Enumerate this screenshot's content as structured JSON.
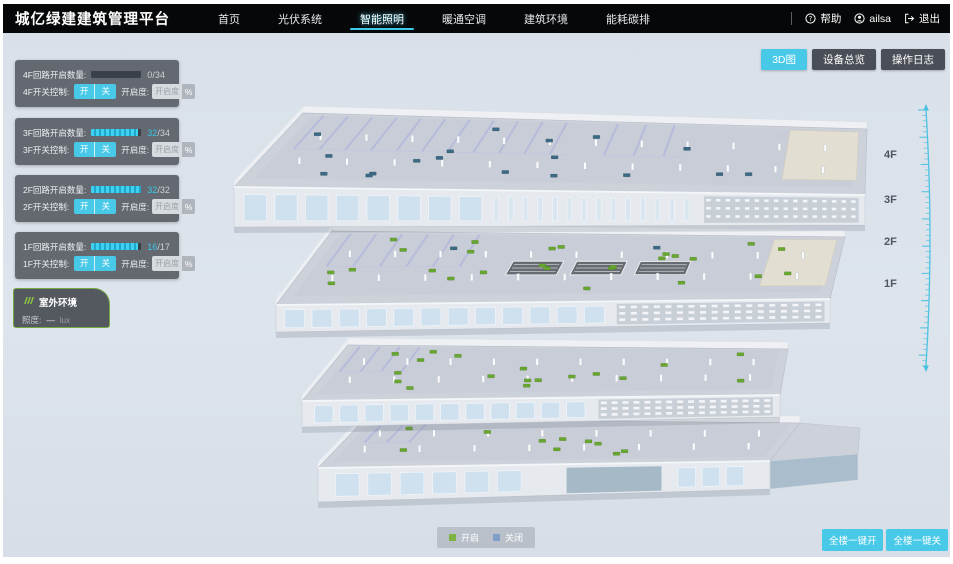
{
  "header": {
    "title": "城亿绿建建筑管理平台",
    "nav": [
      {
        "label": "首页"
      },
      {
        "label": "光伏系统"
      },
      {
        "label": "智能照明"
      },
      {
        "label": "暖通空调"
      },
      {
        "label": "建筑环境"
      },
      {
        "label": "能耗碳排"
      }
    ],
    "active_nav": "智能照明",
    "help": "帮助",
    "user": "ailsa",
    "logout": "退出"
  },
  "toolbar": {
    "buttons": [
      {
        "label": "3D图",
        "active": true
      },
      {
        "label": "设备总览",
        "active": false
      },
      {
        "label": "操作日志",
        "active": false
      }
    ]
  },
  "floor_panels": [
    {
      "floor": "4F",
      "loop_label": "4F回路开启数量:",
      "open": "0",
      "total_disp": "/34",
      "pct": 0,
      "switch_label": "4F开关控制:",
      "on_label": "开",
      "off_label": "关",
      "dim_label": "开启度:",
      "dim_placeholder": "开启度",
      "percent_label": "%"
    },
    {
      "floor": "3F",
      "loop_label": "3F回路开启数量:",
      "open": "32",
      "total_disp": "/34",
      "pct": 94,
      "switch_label": "3F开关控制:",
      "on_label": "开",
      "off_label": "关",
      "dim_label": "开启度:",
      "dim_placeholder": "开启度",
      "percent_label": "%"
    },
    {
      "floor": "2F",
      "loop_label": "2F回路开启数量:",
      "open": "32",
      "total_disp": "/32",
      "pct": 100,
      "switch_label": "2F开关控制:",
      "on_label": "开",
      "off_label": "关",
      "dim_label": "开启度:",
      "dim_placeholder": "开启度",
      "percent_label": "%"
    },
    {
      "floor": "1F",
      "loop_label": "1F回路开启数量:",
      "open": "16",
      "total_disp": "/17",
      "pct": 94,
      "switch_label": "1F开关控制:",
      "on_label": "开",
      "off_label": "关",
      "dim_label": "开启度:",
      "dim_placeholder": "开启度",
      "percent_label": "%"
    }
  ],
  "outdoor": {
    "title": "室外环境",
    "metric_label": "照度:",
    "metric_value": "—",
    "metric_unit": "lux"
  },
  "scene": {
    "floor_labels": [
      "4F",
      "3F",
      "2F",
      "1F"
    ],
    "marker_on_color": "#67a62f",
    "marker_off_color": "#3c6a84",
    "floors": [
      {
        "label": "4F",
        "lights_on": 0,
        "lights_off": 18
      },
      {
        "label": "3F",
        "lights_on": 26,
        "lights_off": 2
      },
      {
        "label": "2F",
        "lights_on": 18,
        "lights_off": 0
      },
      {
        "label": "1F",
        "lights_on": 10,
        "lights_off": 0
      }
    ]
  },
  "legend": [
    {
      "label": "开启",
      "color": "#7cb342"
    },
    {
      "label": "关闭",
      "color": "#7f9fc6"
    }
  ],
  "bulk_actions": [
    {
      "label": "全楼一键开"
    },
    {
      "label": "全楼一键关"
    }
  ]
}
